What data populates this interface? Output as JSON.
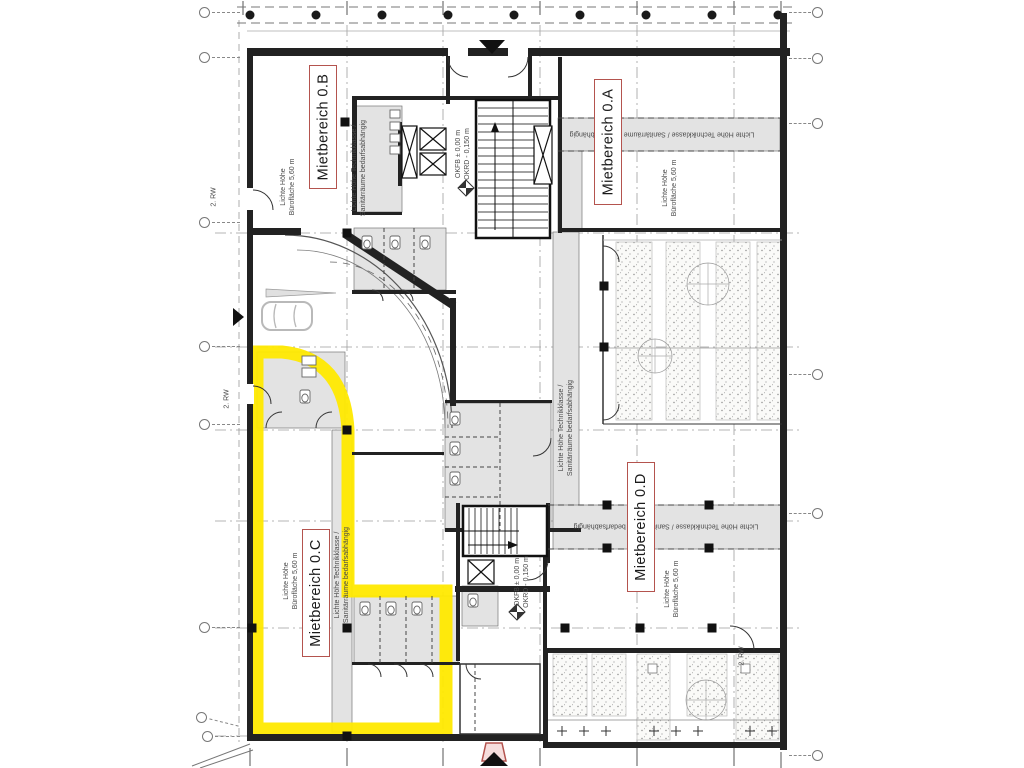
{
  "colors": {
    "highlight_yellow": "#ffe900",
    "label_border_red": "#b4534e",
    "wall_black": "#222222",
    "room_gray": "#e3e3e3",
    "entry_marker_pink": "#f6dedd"
  },
  "area_labels": {
    "a": "Mietbereich 0.A",
    "b": "Mietbereich 0.B",
    "c": "Mietbereich 0.C",
    "d": "Mietbereich 0.D"
  },
  "annotations": {
    "clear_height_office": "Lichte Höhe\nBürofläche 5,60 m",
    "tech_sanitary": "Lichte Höhe Technikklasse /\nSanitärräume bedarfsabhängig",
    "tech_sanitary_inline": "Lichte Höhe Technikklasse / Sanitärräume bedarfsabhängig",
    "level": "OKFB ± 0,00 m\nOKRD - 0,150 m",
    "escape_route": "2. RW"
  }
}
